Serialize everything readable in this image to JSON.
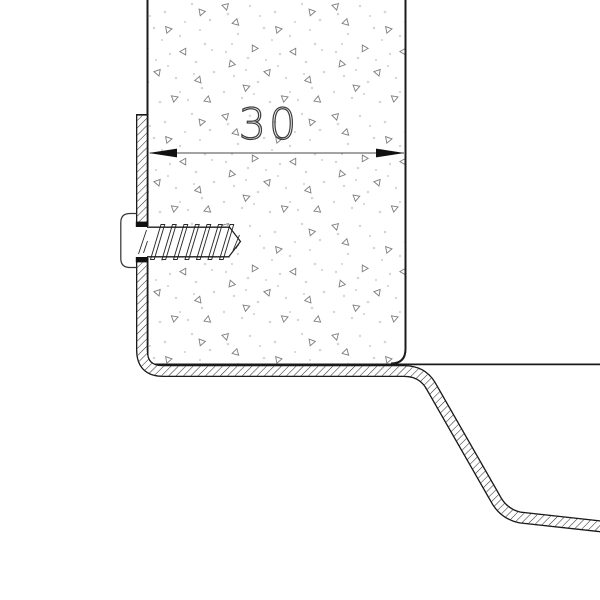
{
  "drawing": {
    "dimension_label": "30",
    "components": {
      "panel": "stippled panel section, 30 units wide",
      "flashing": "hatched sheet-metal edge profile wrapping panel left face and bottom, stepping down to the right",
      "screw": "horizontal fixing screw with clip head driven through profile into panel",
      "dimension": "horizontal width dimension with outward arrowheads"
    },
    "colors": {
      "background": "#ffffff",
      "line": "#1b1b1b",
      "hatch": "#2a2a2a",
      "dimension_line": "#4a4a4a",
      "dimension_text": "#3f3f3f",
      "stipple_dot": "#d6d6d6",
      "stipple_dot_dark": "#bdbdbd",
      "stipple_triangle": "#7d7d7d"
    }
  }
}
